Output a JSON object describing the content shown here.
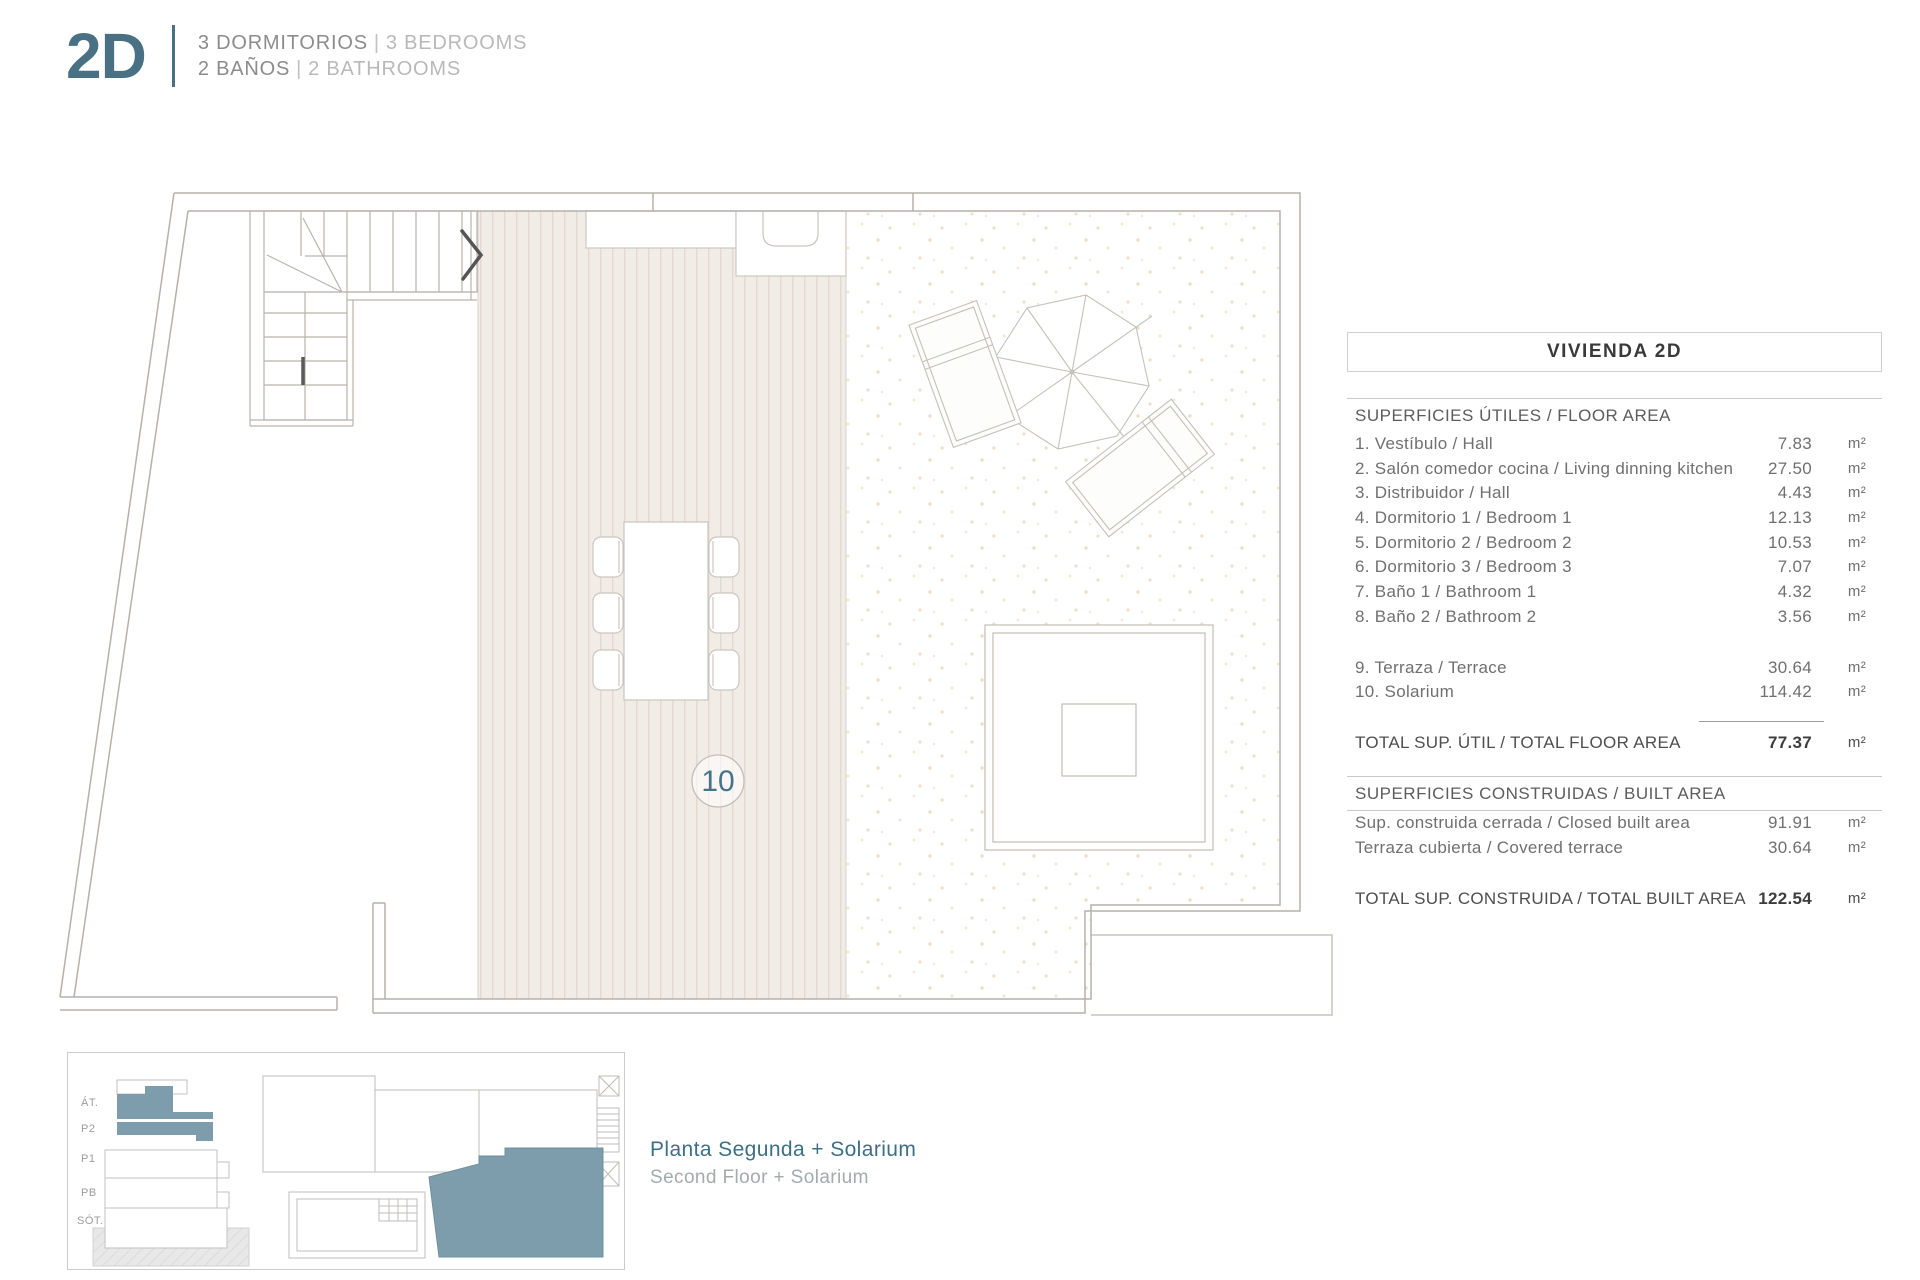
{
  "header": {
    "unit_code": "2D",
    "spec_line1": {
      "es": "3 DORMITORIOS",
      "sep": "|",
      "en": "3 BEDROOMS"
    },
    "spec_line2": {
      "es": "2 BAÑOS",
      "sep": "|",
      "en": "2 BATHROOMS"
    }
  },
  "plan": {
    "solarium_number": "10"
  },
  "table": {
    "title": "VIVIENDA 2D",
    "floor_area": {
      "header": "SUPERFICIES ÚTILES / FLOOR AREA",
      "rows": [
        {
          "label": "1. Vestíbulo / Hall",
          "value": "7.83",
          "unit": "m²"
        },
        {
          "label": "2. Salón comedor cocina / Living dinning kitchen",
          "value": "27.50",
          "unit": "m²"
        },
        {
          "label": "3. Distribuidor / Hall",
          "value": "4.43",
          "unit": "m²"
        },
        {
          "label": "4. Dormitorio 1 / Bedroom 1",
          "value": "12.13",
          "unit": "m²"
        },
        {
          "label": "5. Dormitorio 2 / Bedroom 2",
          "value": "10.53",
          "unit": "m²"
        },
        {
          "label": "6. Dormitorio 3 / Bedroom 3",
          "value": "7.07",
          "unit": "m²"
        },
        {
          "label": "7. Baño 1 / Bathroom 1",
          "value": "4.32",
          "unit": "m²"
        },
        {
          "label": "8. Baño 2 / Bathroom 2",
          "value": "3.56",
          "unit": "m²"
        }
      ],
      "outdoor_rows": [
        {
          "label": "9. Terraza / Terrace",
          "value": "30.64",
          "unit": "m²"
        },
        {
          "label": "10. Solarium",
          "value": "114.42",
          "unit": "m²"
        }
      ],
      "total": {
        "label": "TOTAL SUP. ÚTIL / TOTAL FLOOR AREA",
        "value": "77.37",
        "unit": "m²"
      }
    },
    "built_area": {
      "header": "SUPERFICIES CONSTRUIDAS / BUILT AREA",
      "rows": [
        {
          "label": "Sup. construida cerrada / Closed built area",
          "value": "91.91",
          "unit": "m²"
        },
        {
          "label": "Terraza cubierta / Covered terrace",
          "value": "30.64",
          "unit": "m²"
        }
      ],
      "total": {
        "label": "TOTAL SUP. CONSTRUIDA /  TOTAL BUILT AREA",
        "value": "122.54",
        "unit": "m²"
      }
    }
  },
  "caption": {
    "es": "Planta Segunda + Solarium",
    "en": "Second Floor + Solarium"
  },
  "locator": {
    "levels": [
      "ÁT.",
      "P2",
      "P1",
      "PB",
      "SÓT."
    ]
  },
  "colors": {
    "accent_teal": "#497183",
    "highlight_teal": "#7e9dac",
    "wall_gray": "#b6b0aa"
  }
}
